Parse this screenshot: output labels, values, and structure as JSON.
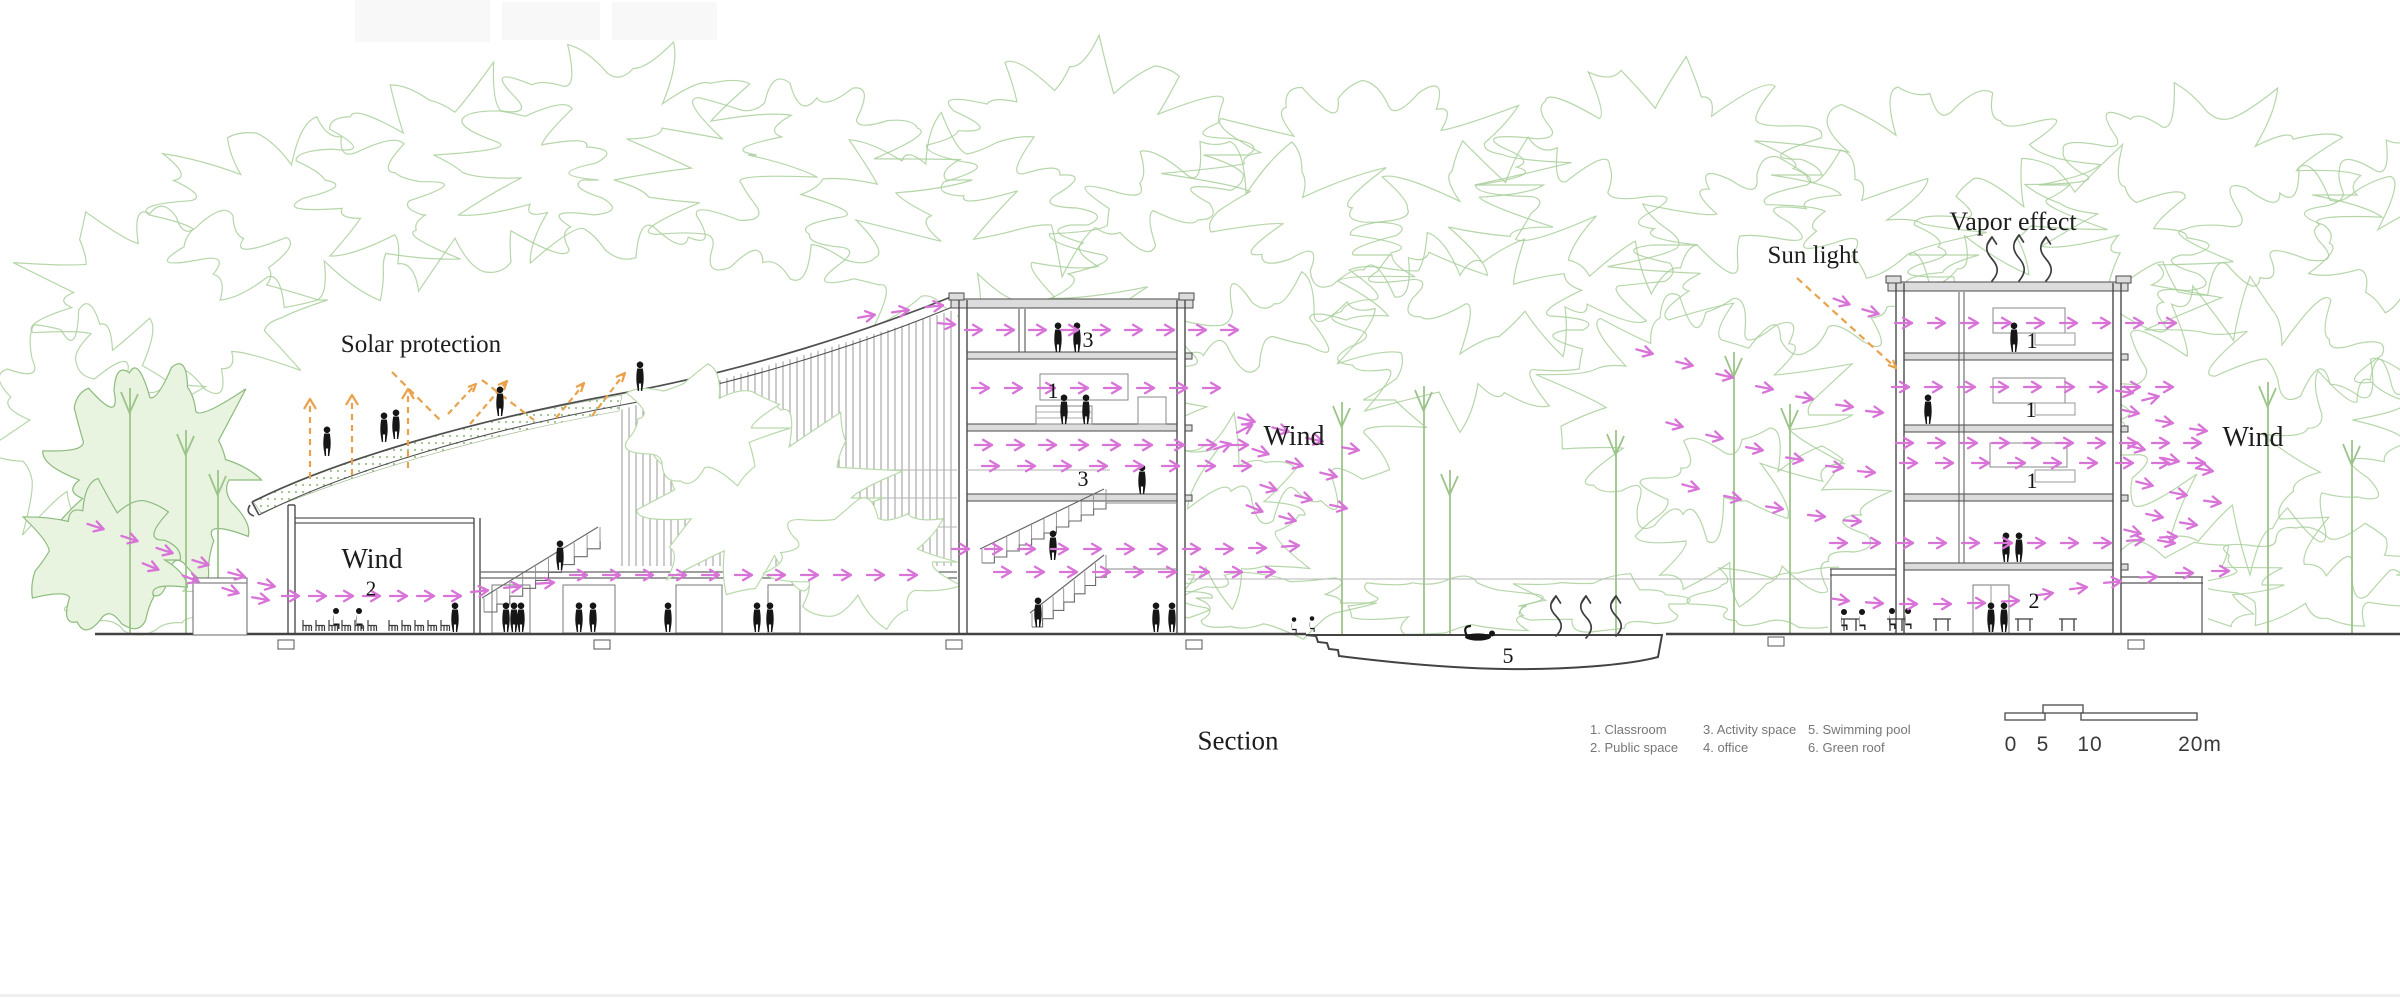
{
  "title": "Section",
  "labels": {
    "solar_protection": "Solar protection",
    "wind_left": "Wind",
    "wind_middle": "Wind",
    "wind_right": "Wind",
    "sun_light": "Sun light",
    "vapor_effect": "Vapor effect"
  },
  "room_numbers": {
    "hall_public_space": "2",
    "mid_activity_top": "3",
    "mid_classroom": "1",
    "mid_activity_lower": "3",
    "right_classroom_f4": "1",
    "right_classroom_f3": "1",
    "right_classroom_f2": "1",
    "right_public_space": "2",
    "swimming_pool": "5"
  },
  "legend": {
    "items": [
      "1. Classroom",
      "2. Public space",
      "3. Activity space",
      "4. office",
      "5. Swimming pool",
      "6. Green roof"
    ]
  },
  "scale_bar": {
    "ticks": [
      "0",
      "5",
      "10"
    ],
    "end_label": "20m"
  },
  "colors": {
    "wind_arrow": "#d873d8",
    "solar_arrow": "#e9a24b",
    "tree_green": "#a9cf9b",
    "line_dark": "#4a4a4a"
  }
}
